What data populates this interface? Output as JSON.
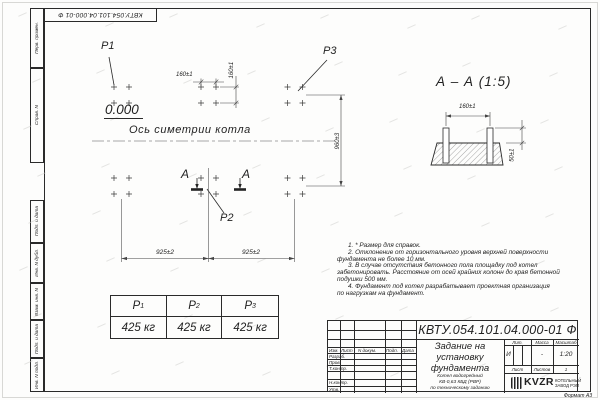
{
  "sheet": {
    "top_designation": "КВТУ.054.101.04.000-01 Ф",
    "margin_labels": [
      "Перв. примен.",
      "Справ. N",
      "Подп. и дата",
      "Инв. N дубл.",
      "Взам. инв. N",
      "Подп. и дата",
      "Инв. N подл."
    ],
    "format_note": "Формат А3"
  },
  "plan": {
    "load_labels": [
      "P1",
      "P2",
      "P3"
    ],
    "elevation": "0.000",
    "axis_label": "Ось симетрии котла",
    "section_letter": "А",
    "dim_bolt_h": "160±1",
    "dim_bolt_v": "160±1",
    "dim_rows": "960±3",
    "dim_cols_left": "925±2",
    "dim_cols_right": "925±2"
  },
  "section": {
    "title": "А – А (1:5)",
    "dim_bolt": "160±1",
    "dim_protrusion": "50±1"
  },
  "load_table": {
    "columns": [
      {
        "label": "P",
        "sub": "1",
        "value": "425 кг"
      },
      {
        "label": "P",
        "sub": "2",
        "value": "425 кг"
      },
      {
        "label": "P",
        "sub": "3",
        "value": "425 кг"
      }
    ]
  },
  "notes": {
    "lines": [
      {
        "text": "1. * Размер для справок.",
        "indent": true
      },
      {
        "text": "2. Отклонение от горизонтального уровня верхней поверхности",
        "indent": true
      },
      {
        "text": "фундамента не более 10 мм.",
        "indent": false
      },
      {
        "text": "3. В случае отсутствия бетонного пола площадку под котел",
        "indent": true
      },
      {
        "text": "забетонировать. Расстояние от осей крайних колонн до края бетонной",
        "indent": false
      },
      {
        "text": "подушки 500 мм.",
        "indent": false
      },
      {
        "text": "4. Фундамент под котел разрабатывает проектная организация",
        "indent": true
      },
      {
        "text": "по нагрузкам на фундамент.",
        "indent": false
      }
    ]
  },
  "title_block": {
    "designation": "КВТУ.054.101.04.000-01 Ф",
    "doc_title_lines": [
      "Задание на",
      "установку",
      "фундамента"
    ],
    "product_lines": [
      "Котел водогрейный",
      "КВ-0,63 КБД (РВР)",
      "по техническому заданию"
    ],
    "header_cells": [
      "Изм.",
      "Лист",
      "N докум.",
      "Подп.",
      "Дата"
    ],
    "row_labels": [
      "Разраб.",
      "Пров.",
      "Т.контр.",
      "Н.контр.",
      "Утв."
    ],
    "lit_header": "Лит.",
    "lit_value": "И",
    "mass_header": "Масса",
    "mass_value": "-",
    "scale_header": "Масштаб",
    "scale_value": "1:20",
    "sheet_label": "Лист",
    "sheets_label": "Листов",
    "sheets_value": "1",
    "logo_text": "KVZR",
    "company_lines": [
      "КОТЕЛЬНЫЙ",
      "ЗАВОД РЭП"
    ]
  }
}
